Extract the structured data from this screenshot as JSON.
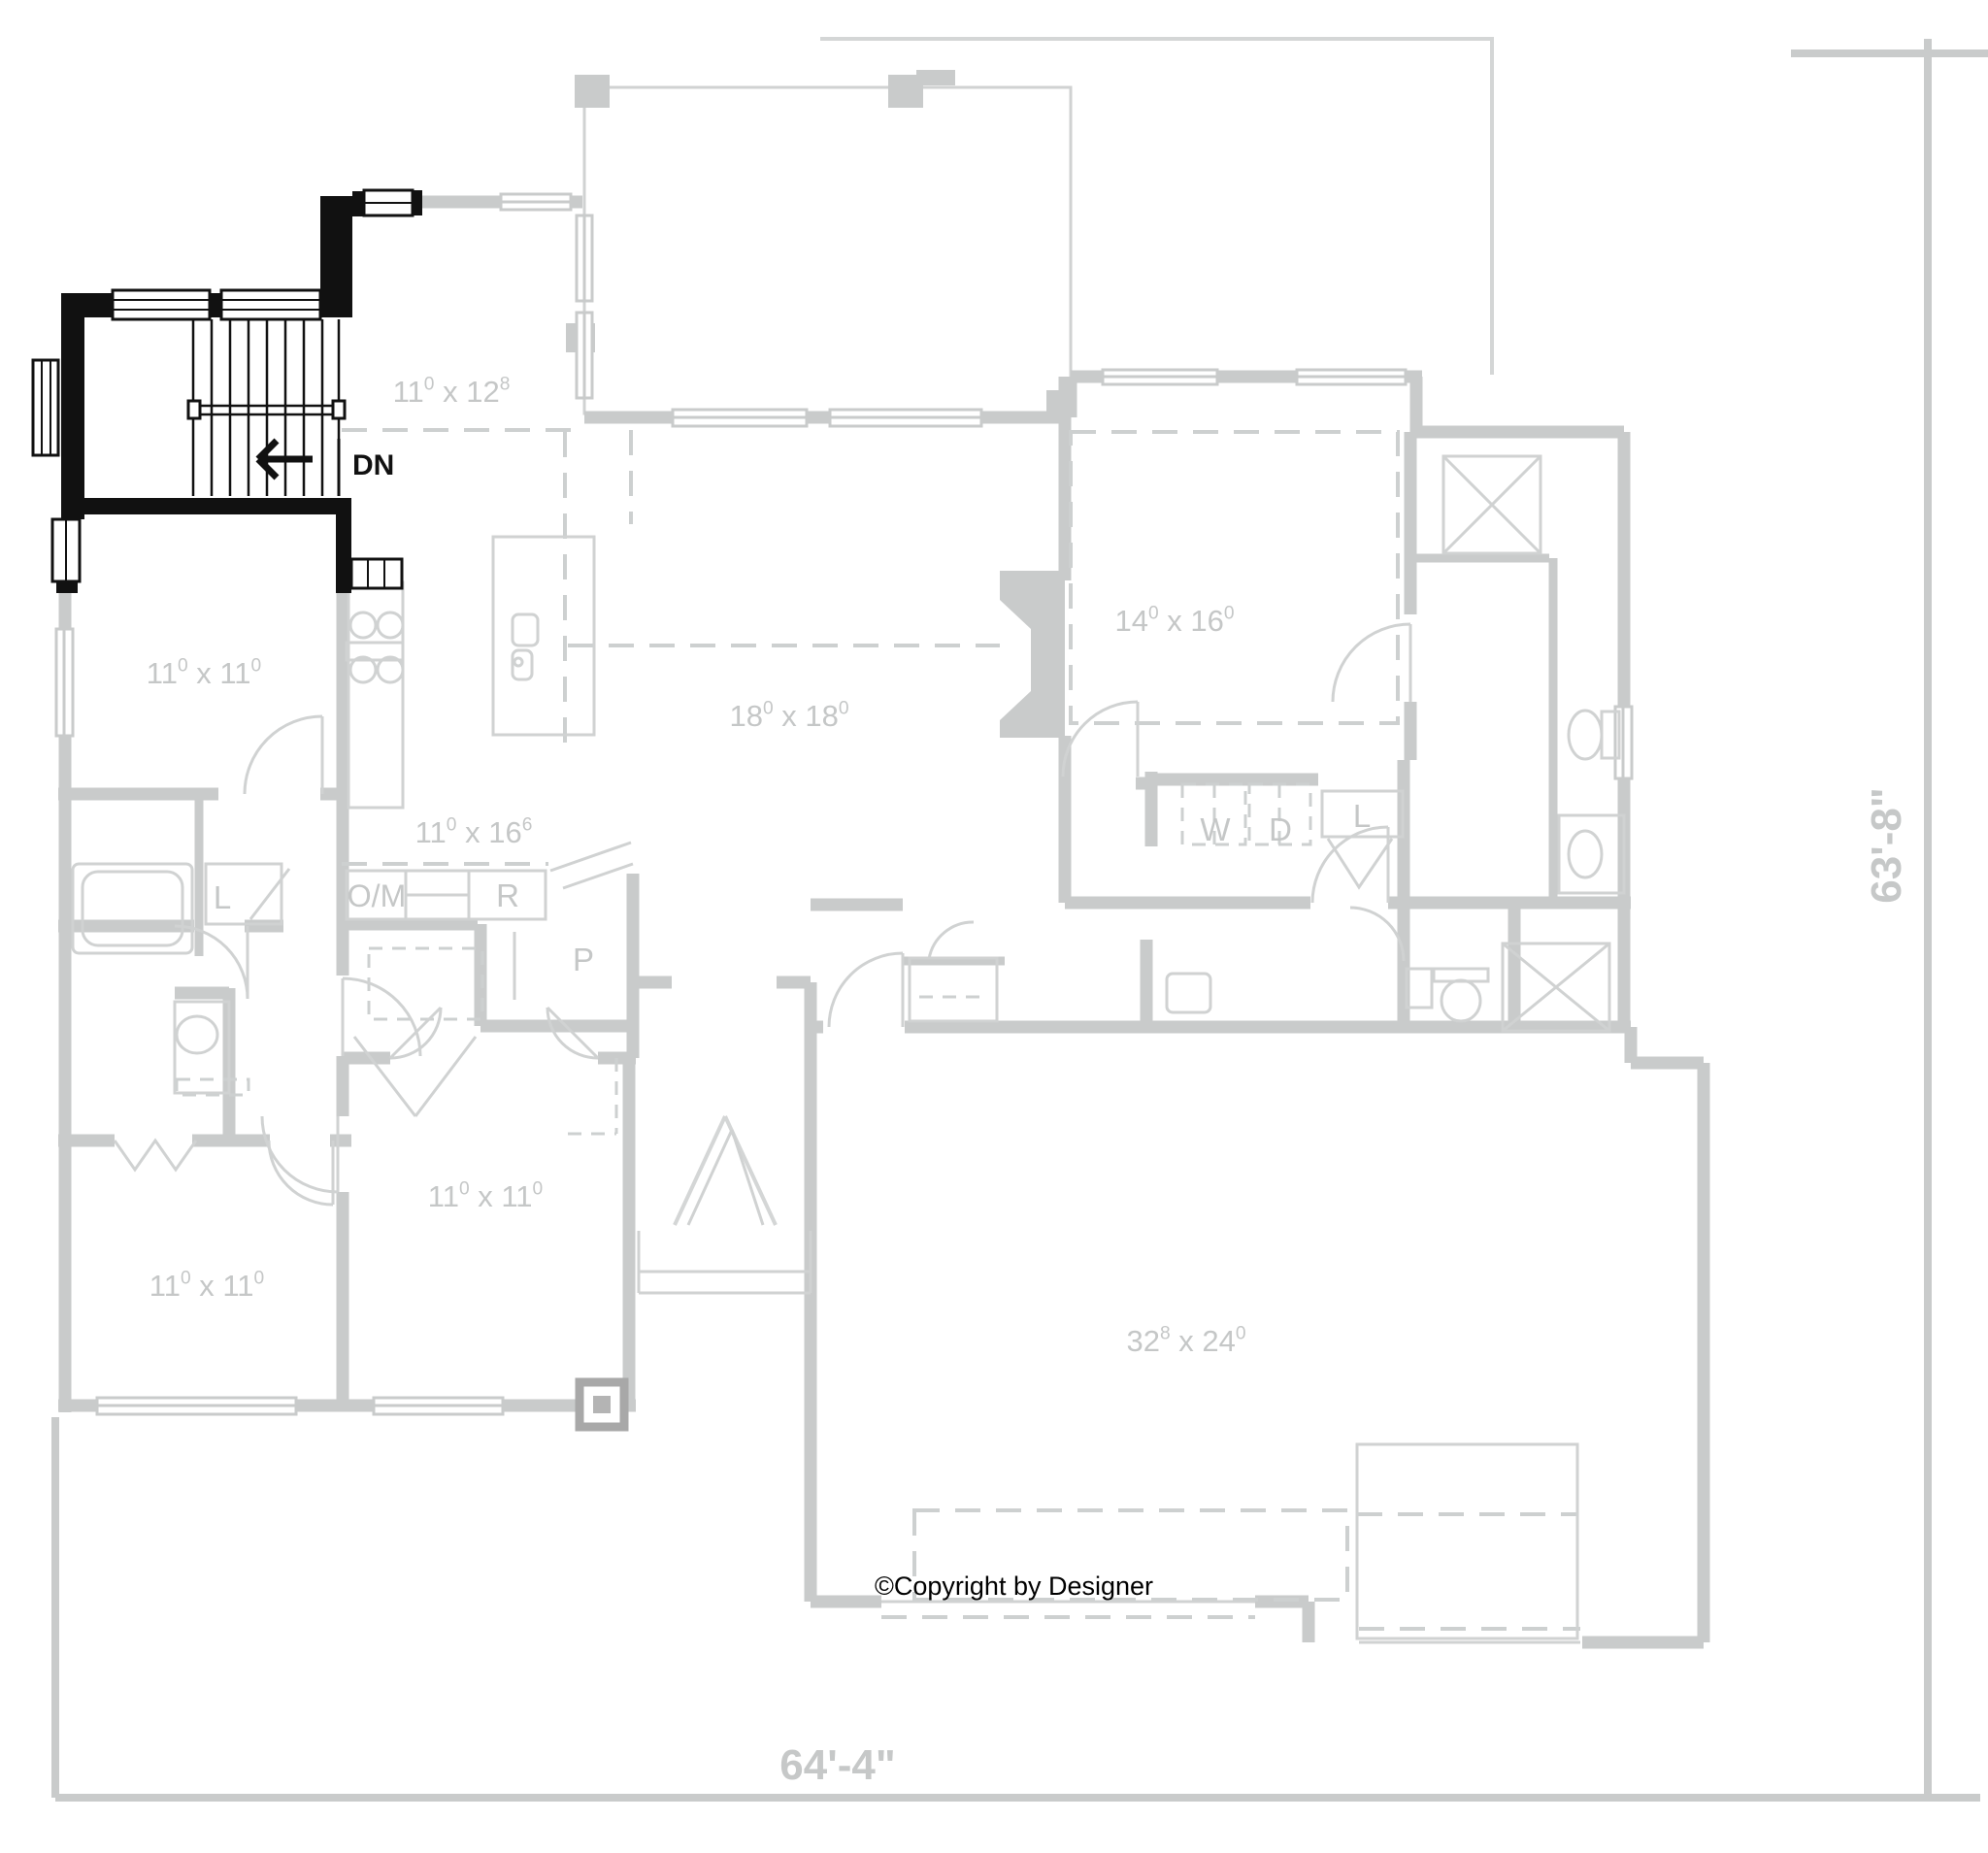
{
  "title": "First floor plan with highlighted stairwell",
  "colors": {
    "walls": "#c9cbcb",
    "text": "#c5c7c7",
    "highlight": "#111111",
    "background": "#ffffff"
  },
  "rooms": [
    {
      "id": "eating",
      "name_lines": [
        "Eating",
        "Area"
      ],
      "dims": {
        "w": "11",
        "w_sup": "0",
        "h": "12",
        "h_sup": "8"
      }
    },
    {
      "id": "covered-porch",
      "name_lines": [
        "COVERED",
        "PORCH"
      ]
    },
    {
      "id": "suite",
      "name_lines": [
        "Suite"
      ],
      "dims": {
        "w": "14",
        "w_sup": "0",
        "h": "16",
        "h_sup": "0"
      },
      "note_lines": [
        "10'-0\" CEILING"
      ]
    },
    {
      "id": "family",
      "name_lines": [
        "Family",
        "Room"
      ],
      "dims": {
        "w": "18",
        "w_sup": "0",
        "h": "18",
        "h_sup": "0"
      },
      "note_lines": [
        "CATHEDRAL",
        "CEILING"
      ]
    },
    {
      "id": "kitchen",
      "name_lines": [
        "Kit."
      ],
      "dims": {
        "w": "11",
        "w_sup": "0",
        "h": "16",
        "h_sup": "6"
      }
    },
    {
      "id": "br2",
      "name_lines": [
        "Br.2"
      ],
      "dims": {
        "w": "11",
        "w_sup": "0",
        "h": "11",
        "h_sup": "0"
      }
    },
    {
      "id": "br3",
      "name_lines": [
        "Br.3"
      ],
      "dims": {
        "w": "11",
        "w_sup": "0",
        "h": "11",
        "h_sup": "0"
      }
    },
    {
      "id": "flex",
      "name_lines": [
        "Flex"
      ],
      "dims": {
        "w": "11",
        "w_sup": "0",
        "h": "11",
        "h_sup": "0"
      }
    },
    {
      "id": "garage",
      "name_lines": [
        "Garage"
      ],
      "dims": {
        "w": "32",
        "w_sup": "8",
        "h": "24",
        "h_sup": "0"
      }
    },
    {
      "id": "bench-hooks",
      "name_lines": [
        "BENCH/",
        "HOOKS"
      ]
    },
    {
      "id": "ceiling-right",
      "name_lines": [
        "10'-0\"",
        "CEILING"
      ]
    }
  ],
  "fixture_labels": [
    {
      "id": "washer",
      "text": "W"
    },
    {
      "id": "dryer",
      "text": "D"
    },
    {
      "id": "linen-laundry",
      "text": "L"
    },
    {
      "id": "linen-bath",
      "text": "L"
    },
    {
      "id": "oven-microwave",
      "text": "O/M"
    },
    {
      "id": "refrigerator",
      "text": "R"
    },
    {
      "id": "pantry",
      "text": "P"
    }
  ],
  "annotations": {
    "stair_direction": "DN",
    "copyright": "©Copyright by Designer"
  },
  "plan_dimensions": {
    "width": "64'-4\"",
    "depth": "63'-8\""
  }
}
